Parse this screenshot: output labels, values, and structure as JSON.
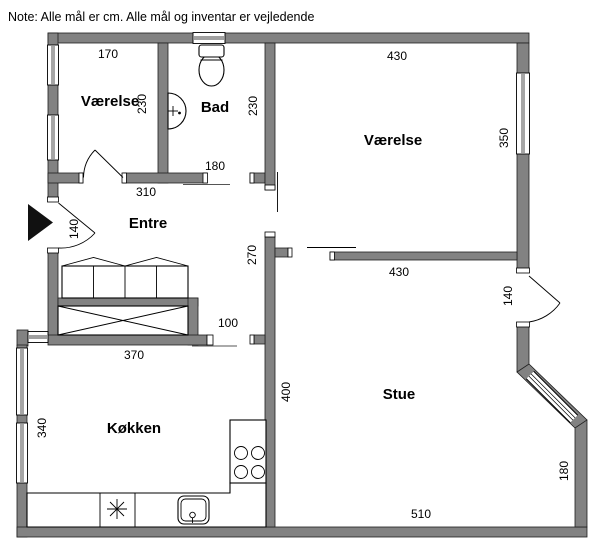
{
  "note": "Note: Alle mål er cm. Alle mål og inventar er vejledende",
  "unit": "cm",
  "rooms": {
    "bedroom_left": {
      "label": "Værelse",
      "width": "170",
      "depth": "230"
    },
    "bathroom": {
      "label": "Bad",
      "depth": "230",
      "door_width": "180"
    },
    "bedroom_right": {
      "label": "Værelse",
      "width": "430",
      "window_side": "350"
    },
    "hall": {
      "label": "Entre",
      "width": "310",
      "entrance_door": "140",
      "passage": "270",
      "kitchen_opening": "100"
    },
    "kitchen": {
      "label": "Køkken",
      "width": "370",
      "depth": "340"
    },
    "living_room": {
      "label": "Stue",
      "north_width": "430",
      "west_depth": "400",
      "balcony_door": "140",
      "east_side": "180",
      "south_width": "510"
    }
  },
  "fixtures": {
    "bathroom": [
      "toilet",
      "washbasin"
    ],
    "hall": [
      "wardrobe",
      "built-in-closet"
    ],
    "kitchen": [
      "dishwasher",
      "kitchen-sink",
      "stove-4-burners",
      "worktop"
    ],
    "entrance": [
      "entrance-arrow"
    ]
  },
  "colors": {
    "wall": "#828282",
    "outline": "#1f1f1f",
    "entrance_marker": "#111111"
  }
}
